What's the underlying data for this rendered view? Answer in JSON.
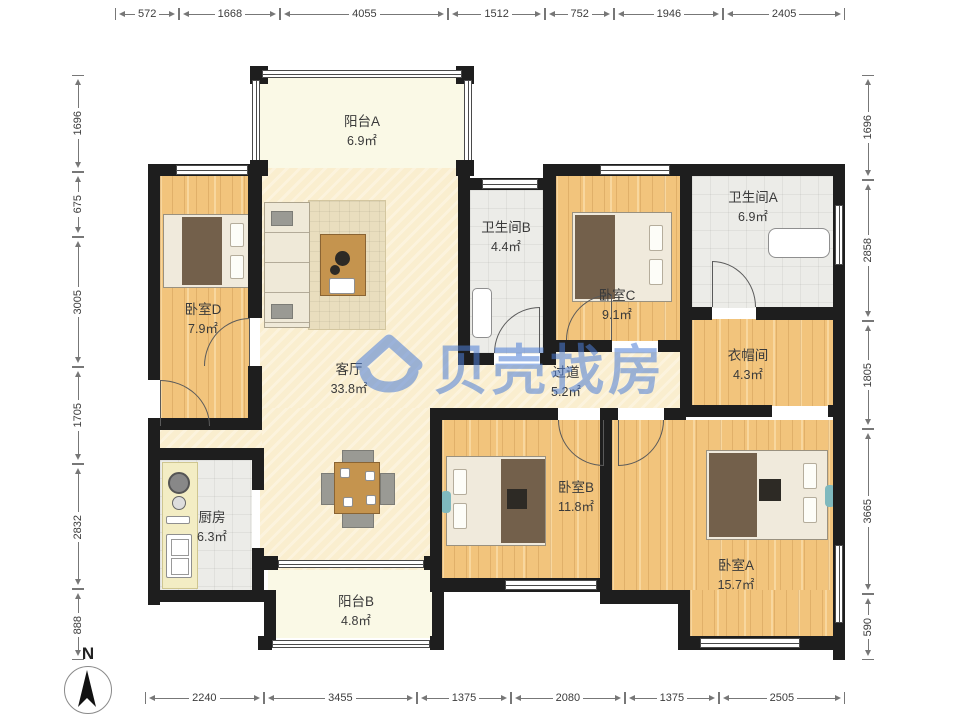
{
  "watermark": {
    "text": "贝壳找房",
    "color": "#4D7ED6"
  },
  "compass": {
    "label": "N"
  },
  "rooms": [
    {
      "id": "balcony-a",
      "name": "阳台A",
      "area": "6.9㎡"
    },
    {
      "id": "bedroom-d",
      "name": "卧室D",
      "area": "7.9㎡"
    },
    {
      "id": "living-room",
      "name": "客厅",
      "area": "33.8㎡"
    },
    {
      "id": "bathroom-b",
      "name": "卫生间B",
      "area": "4.4㎡"
    },
    {
      "id": "bedroom-c",
      "name": "卧室C",
      "area": "9.1㎡"
    },
    {
      "id": "bathroom-a",
      "name": "卫生间A",
      "area": "6.9㎡"
    },
    {
      "id": "cloakroom",
      "name": "衣帽间",
      "area": "4.3㎡"
    },
    {
      "id": "hallway",
      "name": "过道",
      "area": "5.2㎡"
    },
    {
      "id": "kitchen",
      "name": "厨房",
      "area": "6.3㎡"
    },
    {
      "id": "balcony-b",
      "name": "阳台B",
      "area": "4.8㎡"
    },
    {
      "id": "bedroom-b",
      "name": "卧室B",
      "area": "11.8㎡"
    },
    {
      "id": "bedroom-a",
      "name": "卧室A",
      "area": "15.7㎡"
    }
  ],
  "dimensions": {
    "top": [
      572,
      1668,
      4055,
      1512,
      752,
      1946,
      2405
    ],
    "left": [
      1696,
      675,
      3005,
      1705,
      2832,
      888
    ],
    "right": [
      1696,
      2858,
      1805,
      3665,
      590
    ],
    "bottom": [
      2240,
      3455,
      1375,
      2080,
      1375,
      2505
    ]
  }
}
